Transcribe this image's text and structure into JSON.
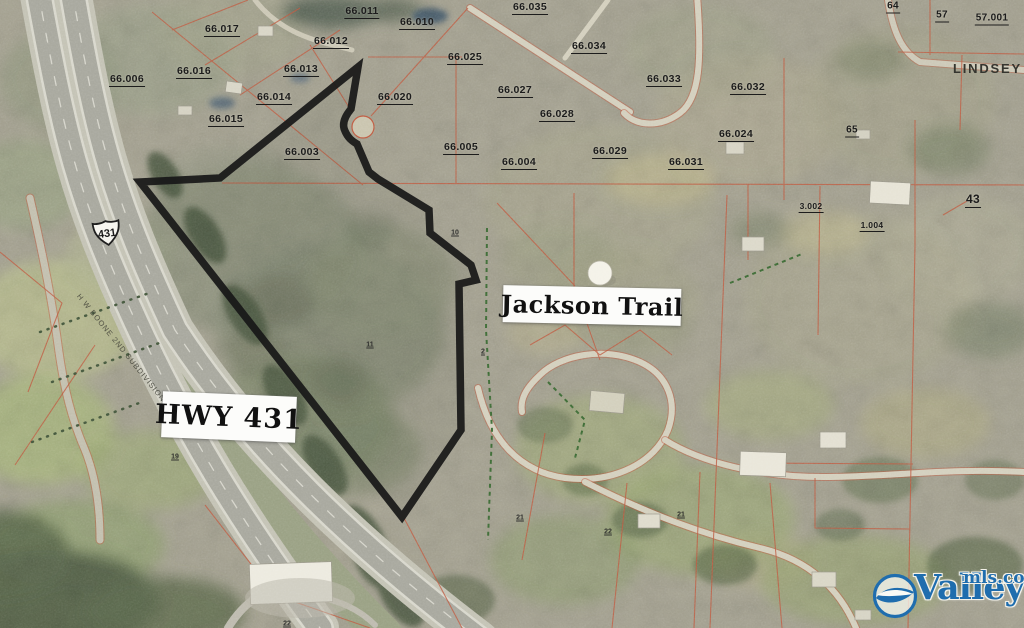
{
  "map": {
    "parcel_labels": [
      {
        "text": "66.017",
        "x": 222,
        "y": 30
      },
      {
        "text": "66.011",
        "x": 362,
        "y": 12
      },
      {
        "text": "66.010",
        "x": 417,
        "y": 23
      },
      {
        "text": "66.012",
        "x": 331,
        "y": 42
      },
      {
        "text": "66.016",
        "x": 194,
        "y": 72
      },
      {
        "text": "66.013",
        "x": 301,
        "y": 70
      },
      {
        "text": "66.006",
        "x": 127,
        "y": 80
      },
      {
        "text": "66.014",
        "x": 274,
        "y": 98
      },
      {
        "text": "66.015",
        "x": 226,
        "y": 120
      },
      {
        "text": "66.020",
        "x": 395,
        "y": 98
      },
      {
        "text": "66.025",
        "x": 465,
        "y": 58
      },
      {
        "text": "66.005",
        "x": 461,
        "y": 148
      },
      {
        "text": "66.003",
        "x": 302,
        "y": 153
      },
      {
        "text": "66.035",
        "x": 530,
        "y": 8
      },
      {
        "text": "66.034",
        "x": 589,
        "y": 47
      },
      {
        "text": "66.033",
        "x": 664,
        "y": 80
      },
      {
        "text": "66.032",
        "x": 748,
        "y": 88
      },
      {
        "text": "66.027",
        "x": 515,
        "y": 91
      },
      {
        "text": "66.028",
        "x": 557,
        "y": 115
      },
      {
        "text": "66.029",
        "x": 610,
        "y": 152
      },
      {
        "text": "66.024",
        "x": 736,
        "y": 135
      },
      {
        "text": "66.031",
        "x": 686,
        "y": 163
      },
      {
        "text": "66.004",
        "x": 519,
        "y": 163
      },
      {
        "text": "64",
        "x": 893,
        "y": 7,
        "s": 10
      },
      {
        "text": "57",
        "x": 942,
        "y": 16,
        "s": 10
      },
      {
        "text": "57.001",
        "x": 992,
        "y": 19,
        "s": 10
      },
      {
        "text": "65",
        "x": 852,
        "y": 131,
        "s": 10
      },
      {
        "text": "43",
        "x": 973,
        "y": 200,
        "s": 12
      },
      {
        "text": "3.002",
        "x": 811,
        "y": 207,
        "s": 8.5
      },
      {
        "text": "1.004",
        "x": 872,
        "y": 226,
        "s": 8.5
      }
    ],
    "tiny_labels": [
      {
        "text": "19",
        "x": 175,
        "y": 457
      },
      {
        "text": "11",
        "x": 370,
        "y": 345
      },
      {
        "text": "10",
        "x": 455,
        "y": 233
      },
      {
        "text": "2",
        "x": 483,
        "y": 352
      },
      {
        "text": "21",
        "x": 520,
        "y": 518
      },
      {
        "text": "22",
        "x": 608,
        "y": 532
      },
      {
        "text": "21",
        "x": 681,
        "y": 515
      },
      {
        "text": "22",
        "x": 287,
        "y": 624
      }
    ],
    "street_label": {
      "text": "LINDSEY LA"
    },
    "rotated_label": {
      "text": "H W BOONE 2ND SUBDIVISION"
    },
    "route_shield": {
      "text": "431"
    }
  },
  "overlay_labels": {
    "hwy": {
      "text": "HWY 431"
    },
    "trail": {
      "text": "Jackson Trail"
    }
  },
  "watermark": {
    "brand": "Valley",
    "suffix": "mls.com",
    "color": "#1f6dae"
  },
  "colors": {
    "parcel_line": "#bf5a40",
    "boundary": "#181818",
    "dashed_green": "#3d6b35",
    "road_fill": "#d3cfbd",
    "highway_asphalt": "#a7a79d"
  }
}
